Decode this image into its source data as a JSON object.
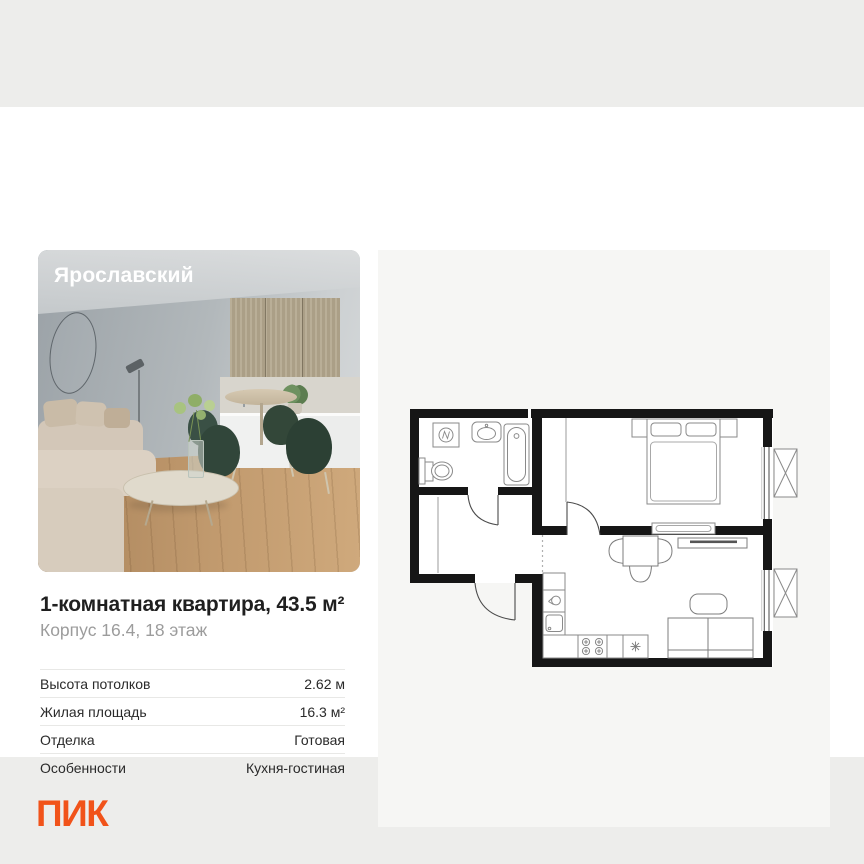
{
  "page": {
    "background_color": "#ededeb",
    "card_background": "#ffffff",
    "panel_background": "#f6f6f4"
  },
  "photo": {
    "label": "Ярославский"
  },
  "listing": {
    "title": "1-комнатная квартира, 43.5 м²",
    "subtitle": "Корпус 16.4, 18 этаж",
    "specs": [
      {
        "label": "Высота потолков",
        "value": "2.62 м"
      },
      {
        "label": "Жилая площадь",
        "value": "16.3 м²"
      },
      {
        "label": "Отделка",
        "value": "Готовая"
      },
      {
        "label": "Особенности",
        "value": "Кухня-гостиная"
      }
    ]
  },
  "brand": {
    "logo_text": "ПИК",
    "logo_color": "#f1531a"
  },
  "floor_plan": {
    "icons": [
      "washing-machine-icon",
      "sink-icon",
      "bathtub-icon",
      "toilet-icon",
      "double-bed-icon",
      "wardrobe-icon",
      "tv-stand-icon",
      "dining-table-icon",
      "chair-icon",
      "coffee-table-icon",
      "sofa-icon",
      "kitchen-sink-icon",
      "stove-icon",
      "fridge-snowflake-icon",
      "window-icon",
      "balcony-icon",
      "door-swing-icon"
    ]
  }
}
